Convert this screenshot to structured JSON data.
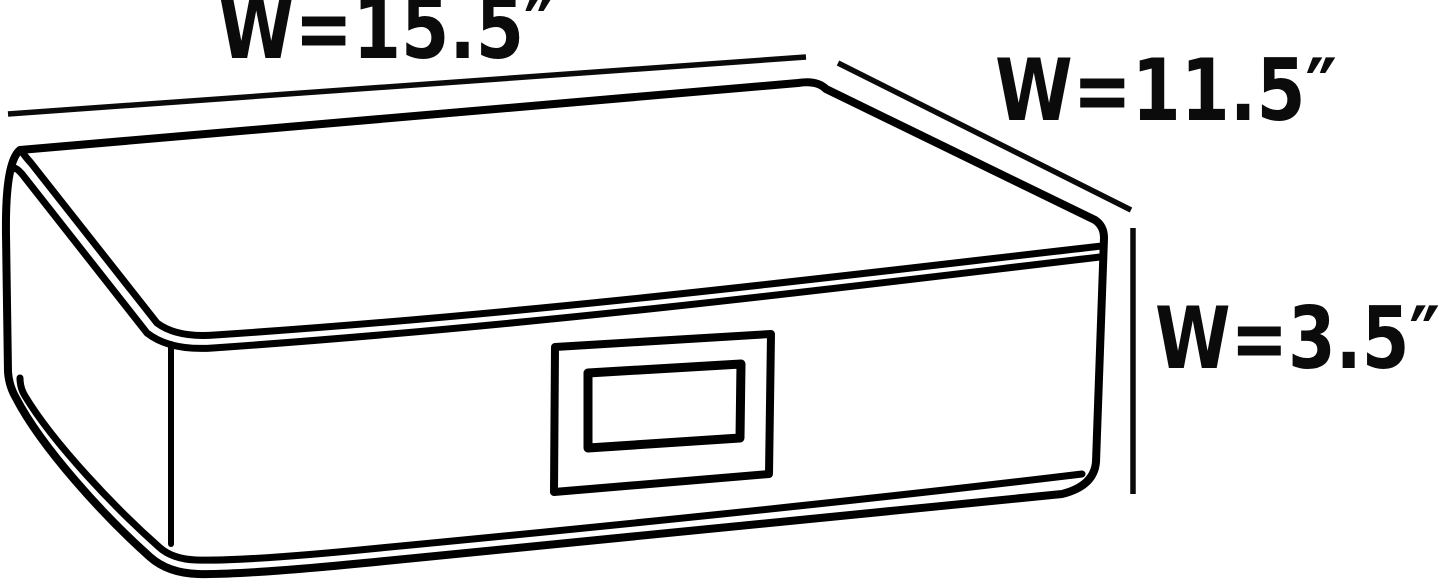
{
  "diagram": {
    "type": "product-dimension-diagram",
    "subject": "soft-sided storage box with label window",
    "labels": {
      "top_width": "W=15.5″",
      "side_depth": "W=11.5″",
      "height": "W=3.5″"
    },
    "dimensions": [
      {
        "label": "W=15.5″",
        "value": 15.5,
        "unit": "inches",
        "edge": "top-back width"
      },
      {
        "label": "W=11.5″",
        "value": 11.5,
        "unit": "inches",
        "edge": "top-right depth"
      },
      {
        "label": "W=3.5″",
        "value": 3.5,
        "unit": "inches",
        "edge": "right-side height"
      }
    ],
    "colors": {
      "background": "#ffffff",
      "box_fill": "#b8b8b8",
      "line": "#000000",
      "label_window_fill": "#ffffff",
      "text": "#0b0b0b"
    }
  }
}
